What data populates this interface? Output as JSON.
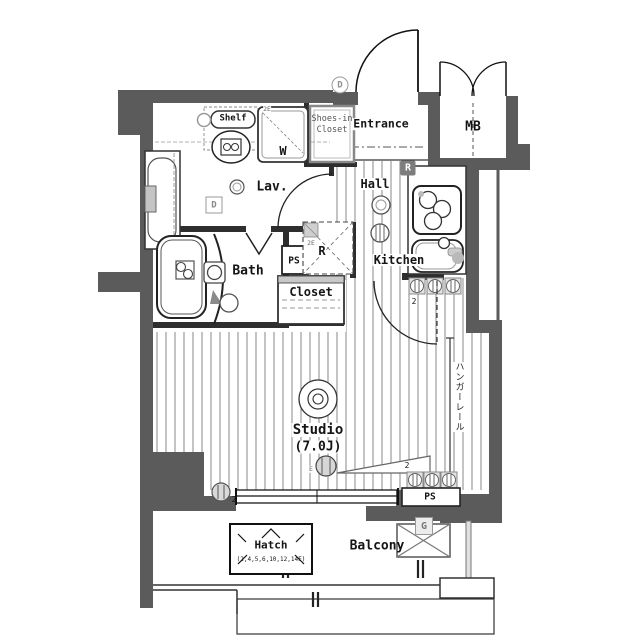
{
  "plan": {
    "rooms": {
      "entrance": "Entrance",
      "mb": "MB",
      "lav": "Lav.",
      "hall": "Hall",
      "kitchen": "Kitchen",
      "bath": "Bath",
      "closet": "Closet",
      "studio": "Studio",
      "studio_size": "(7.0J)",
      "balcony": "Balcony"
    },
    "fixtures": {
      "shelf": "Shelf",
      "washer": "W",
      "shoes_closet_l1": "Shoes-in",
      "shoes_closet_l2": "Closet",
      "ps_upper": "PS",
      "ps_lower": "PS",
      "refrigerator": "R",
      "hanger_rail": "ハンガーレール",
      "hatch": "Hatch",
      "hatch_floors": "(2,4,5,6,10,12,14F)",
      "gas_meter": "G"
    },
    "badges": {
      "refrigerator": "R",
      "entrance_d": "D",
      "lav_d": "D"
    },
    "notes": {
      "outlet_kitchen": "2",
      "outlet_left": "2",
      "outlet_right": "2",
      "mark_2e_a": "2E",
      "mark_2e_b": "2E",
      "mark_e": "E"
    }
  }
}
